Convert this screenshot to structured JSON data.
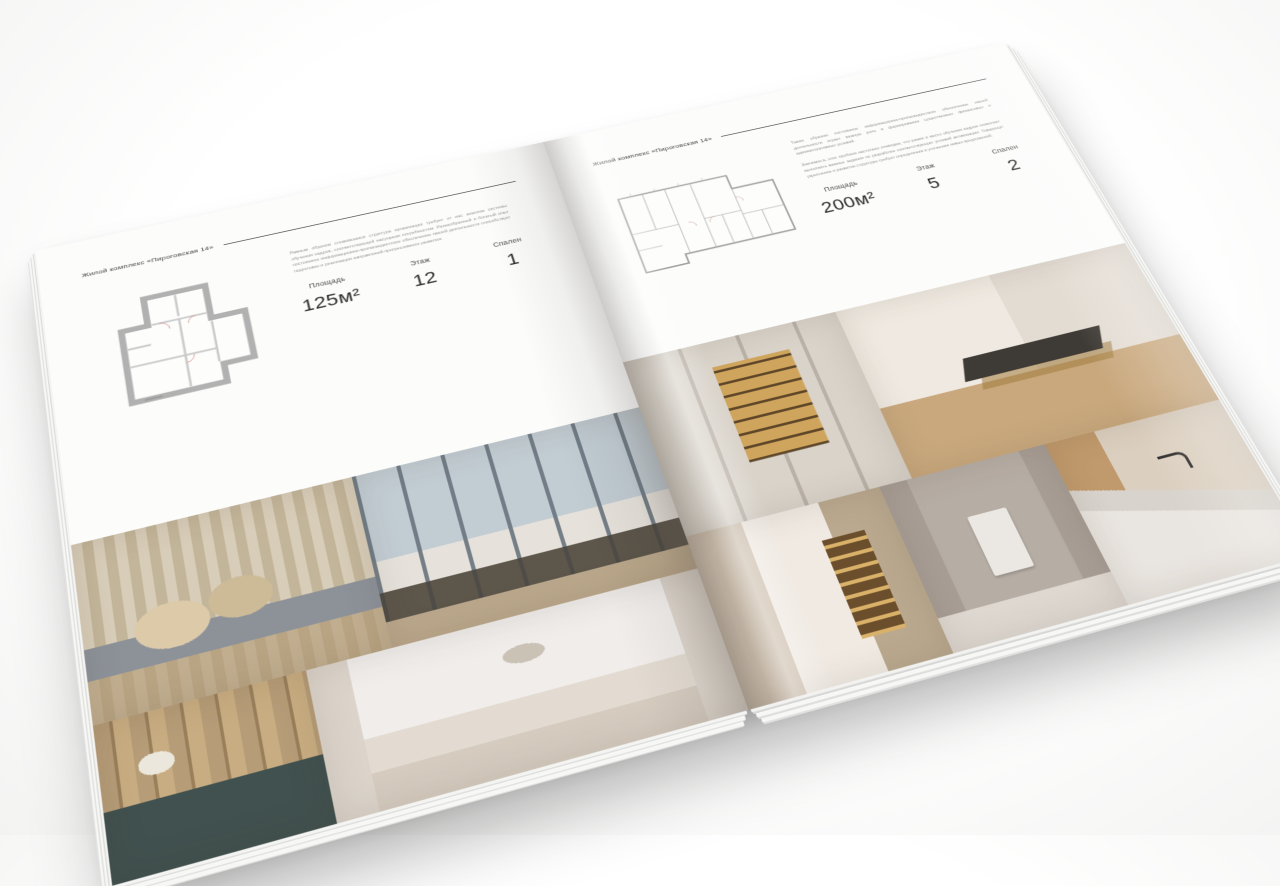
{
  "book": {
    "left_page": {
      "header": "Жилой комплекс «Пироговская 14»",
      "paragraph": "Равным образом сложившаяся структура организации требует от нас анализа системы обучения кадров, соответствующей насущным потребностям. Разнообразный и богатый опыт постоянное информационно-пропагандистское обеспечение нашей деятельности способствует подготовке и реализации направлений прогрессивного развития.",
      "specs": [
        {
          "label": "Площадь",
          "value": "125м²"
        },
        {
          "label": "Этаж",
          "value": "12"
        },
        {
          "label": "Спален",
          "value": "1"
        }
      ],
      "photos": [
        "bedroom with beige pillows",
        "bedroom with panoramic windows and chaise",
        "closet with flowers and teal cabinet",
        "white bedroom with arch decor"
      ]
    },
    "right_page": {
      "header": "Жилой комплекс «Пироговская 14»",
      "paragraphs": [
        "Таким образом постоянное информационно-пропагандистское обеспечение нашей деятельности играет важную роль в формировании существенных финансовых и административных условий.",
        "Значимость этих проблем настолько очевидна, что рамки и место обучения кадров позволяет выполнять важные задания по разработке соответствующих условий активизации. Товарищи! укрепление и развитие структуры требует определения и уточнения новых предложений."
      ],
      "specs": [
        {
          "label": "Площадь",
          "value": "200м²"
        },
        {
          "label": "Этаж",
          "value": "5"
        },
        {
          "label": "Спален",
          "value": "2"
        }
      ],
      "photos": [
        "wardrobe with gold glass shelving",
        "study with desk and gold-leg table",
        "corridor with lit shelf",
        "bathroom with towel",
        "kitchen counter with black faucet"
      ]
    },
    "palette": {
      "page": "#fcfcfb",
      "rule": "#474747",
      "plan_wall": "#b1b1b1",
      "photo_warm": "#cfa45c",
      "photo_beige": "#d8cfbf"
    }
  }
}
